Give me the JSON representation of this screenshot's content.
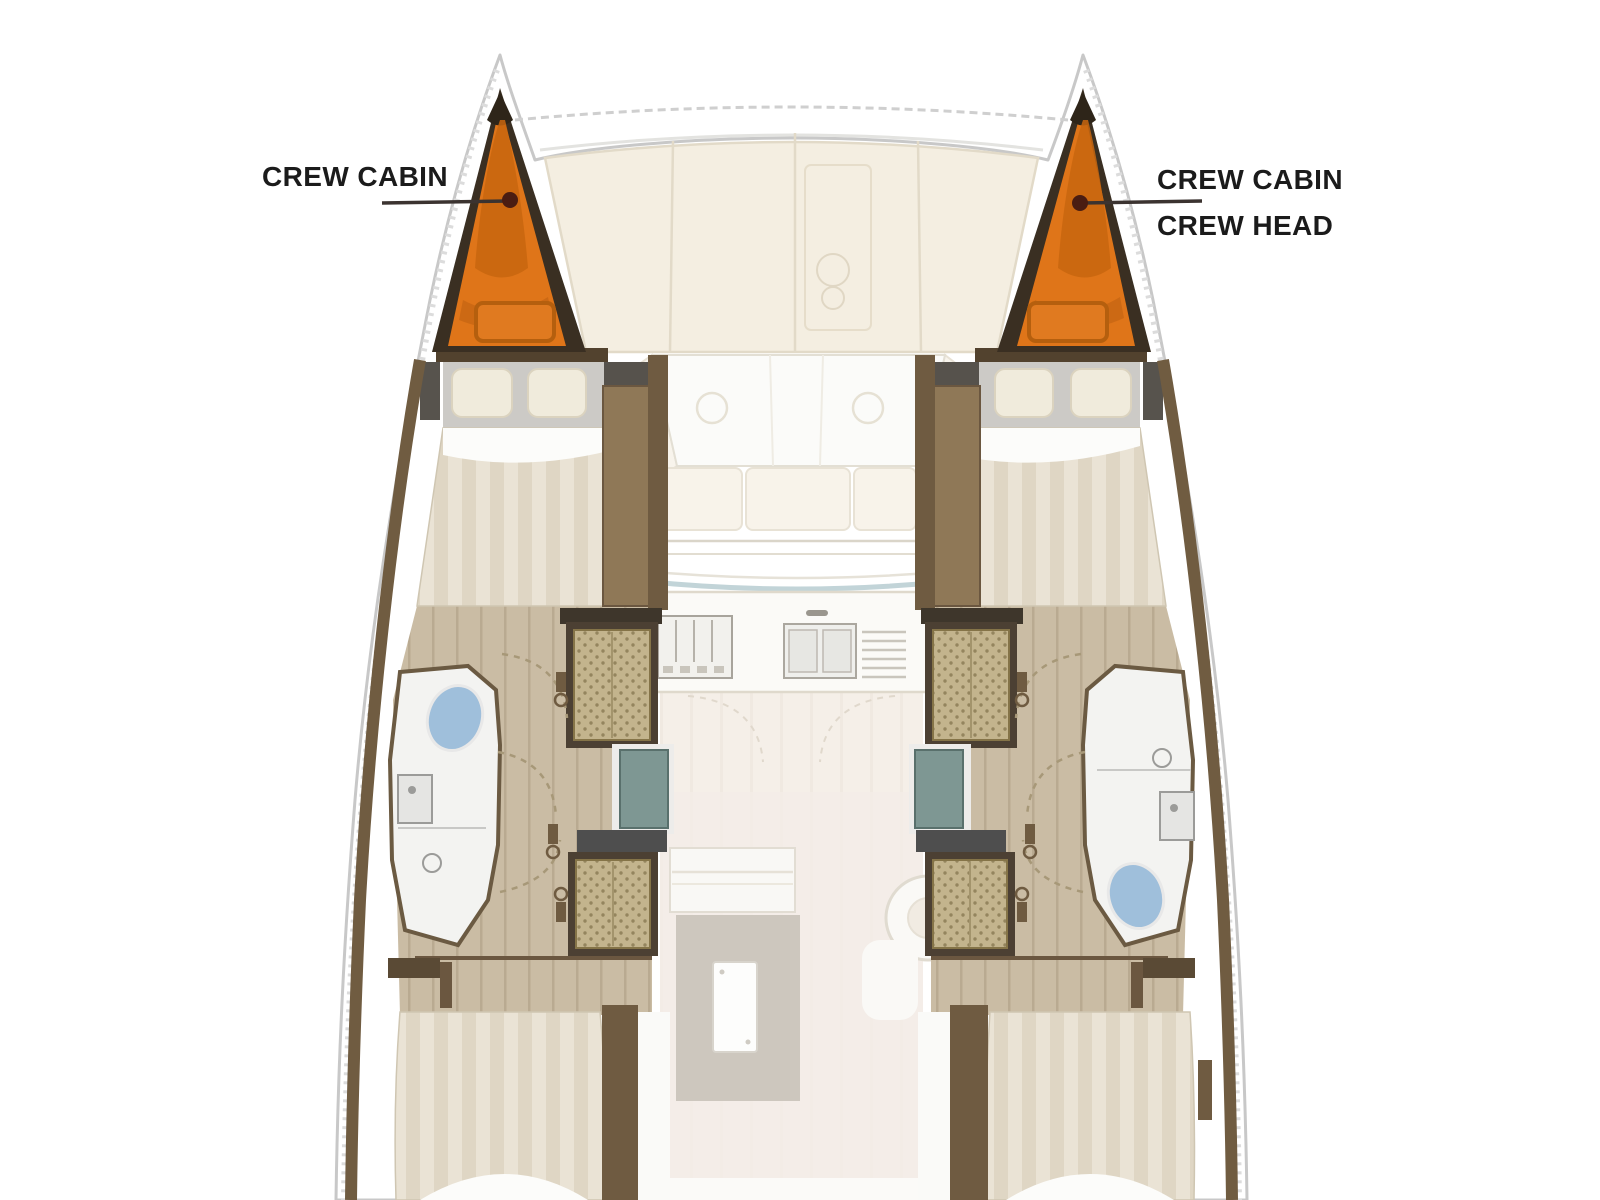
{
  "diagram": {
    "kind": "catamaran-interior-floor-plan",
    "labels": {
      "port_bow": "CREW CABIN",
      "starboard_bow_line1": "CREW CABIN",
      "starboard_bow_line2": "CREW HEAD"
    },
    "highlighted_areas": [
      {
        "name": "crew-cabin-port",
        "location": "port bow",
        "highlight": "orange"
      },
      {
        "name": "crew-cabin-crew-head-starboard",
        "location": "starboard bow",
        "highlight": "orange"
      }
    ],
    "rooms_depicted": [
      "crew cabin port bow",
      "crew cabin / crew head starboard bow",
      "forward double cabin port",
      "forward double cabin starboard",
      "head with toilet, sink and shower port",
      "head with toilet, sink and shower starboard",
      "wardrobe units",
      "salon forward sofa",
      "galley with stove and double sink",
      "dinette with table and rug",
      "helm seat",
      "aft double cabin port",
      "aft double cabin starboard"
    ]
  },
  "colors": {
    "label-text": "#1b1b1b",
    "highlight-orange": "#DF7519",
    "highlight-orange-dark": "#C8660F",
    "highlight-border": "#3A2F22",
    "leader-line": "#3B3330",
    "leader-dot": "#4A1D12",
    "wall-brown": "#6F5B41",
    "frame-dark": "#4C4033",
    "band-black": "#3E362B",
    "wood-floor": "#CABCA4",
    "wood-line": "#B9AA91",
    "deck-cream": "#F4EEE1",
    "deck-line": "#E2DAC8",
    "bed-stripe-a": "#EAE3D5",
    "bed-stripe-b": "#DFD6C4",
    "sheet-white": "#FCFCFA",
    "headboard-grey": "#CCCAC6",
    "pillow-cream": "#F0EBDC",
    "wicker-base": "#C3B48D",
    "wicker-dot": "#94855E",
    "glass-teal": "#7E9793",
    "toilet-blue": "#9FBFDB",
    "bathroom-white": "#F3F3F1",
    "rug-grey": "#CDC7BE",
    "salon-floor": "#F5EFE8",
    "hull-stroke": "#C8C8C8"
  }
}
